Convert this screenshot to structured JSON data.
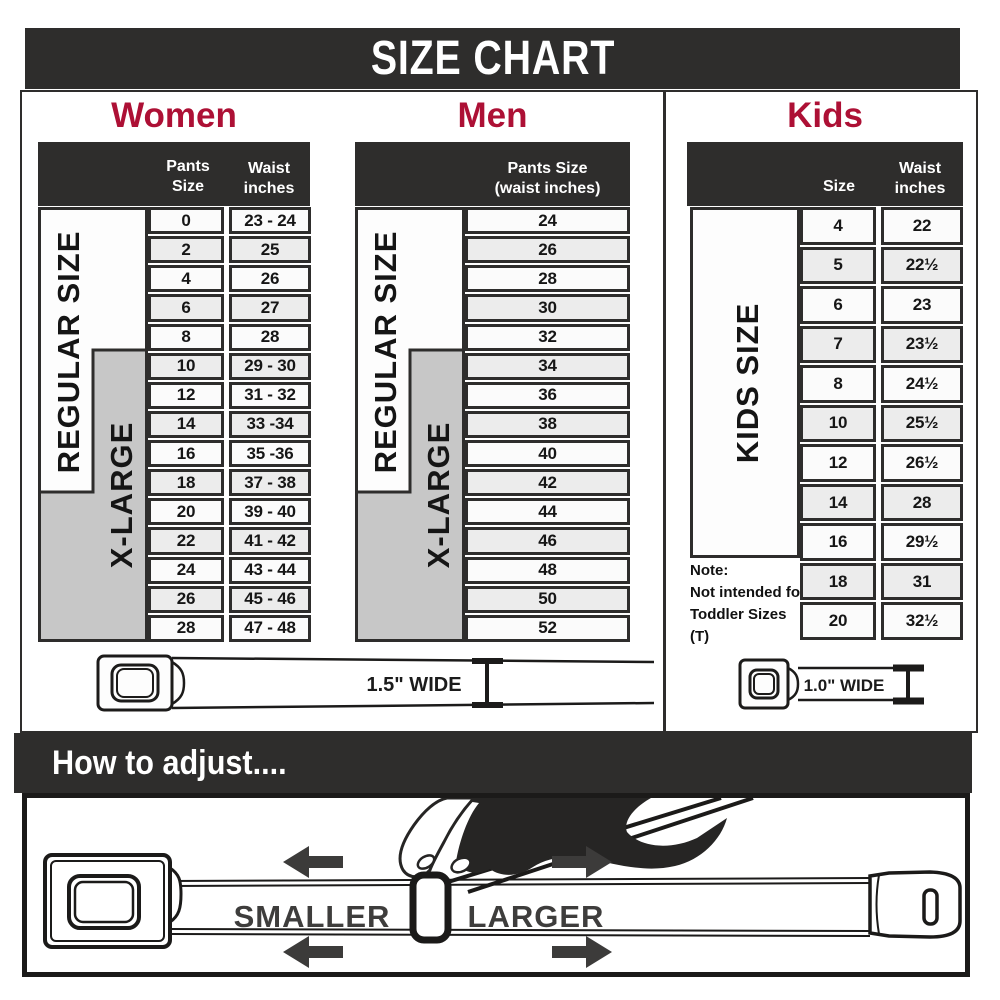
{
  "banner": {
    "title": "SIZE CHART"
  },
  "women": {
    "heading": "Women",
    "header": {
      "col1": "Pants Size",
      "col2_line1": "Waist",
      "col2_line2": "inches"
    },
    "labels": {
      "regular": "REGULAR SIZE",
      "xlarge": "X-LARGE"
    },
    "rows": [
      {
        "size": "0",
        "waist": "23 - 24"
      },
      {
        "size": "2",
        "waist": "25"
      },
      {
        "size": "4",
        "waist": "26"
      },
      {
        "size": "6",
        "waist": "27"
      },
      {
        "size": "8",
        "waist": "28"
      },
      {
        "size": "10",
        "waist": "29 - 30"
      },
      {
        "size": "12",
        "waist": "31 - 32"
      },
      {
        "size": "14",
        "waist": "33 -34"
      },
      {
        "size": "16",
        "waist": "35 -36"
      },
      {
        "size": "18",
        "waist": "37 - 38"
      },
      {
        "size": "20",
        "waist": "39 - 40"
      },
      {
        "size": "22",
        "waist": "41 - 42"
      },
      {
        "size": "24",
        "waist": "43 - 44"
      },
      {
        "size": "26",
        "waist": "45 - 46"
      },
      {
        "size": "28",
        "waist": "47 - 48"
      }
    ]
  },
  "men": {
    "heading": "Men",
    "header": {
      "line1": "Pants Size",
      "line2": "(waist inches)"
    },
    "labels": {
      "regular": "REGULAR SIZE",
      "xlarge": "X-LARGE"
    },
    "rows": [
      "24",
      "26",
      "28",
      "30",
      "32",
      "34",
      "36",
      "38",
      "40",
      "42",
      "44",
      "46",
      "48",
      "50",
      "52"
    ]
  },
  "kids": {
    "heading": "Kids",
    "header": {
      "col1": "Size",
      "col2_line1": "Waist",
      "col2_line2": "inches"
    },
    "labels": {
      "side": "KIDS SIZE"
    },
    "note": {
      "line1": "Note:",
      "line2": "Not intended for",
      "line3": "Toddler Sizes (T)"
    },
    "rows": [
      {
        "size": "4",
        "waist": "22"
      },
      {
        "size": "5",
        "waist": "22½"
      },
      {
        "size": "6",
        "waist": "23"
      },
      {
        "size": "7",
        "waist": "23½"
      },
      {
        "size": "8",
        "waist": "24½"
      },
      {
        "size": "10",
        "waist": "25½"
      },
      {
        "size": "12",
        "waist": "26½"
      },
      {
        "size": "14",
        "waist": "28"
      },
      {
        "size": "16",
        "waist": "29½"
      },
      {
        "size": "18",
        "waist": "31"
      },
      {
        "size": "20",
        "waist": "32½"
      }
    ]
  },
  "belts": {
    "adult_label": "1.5\" WIDE",
    "kids_label": "1.0\" WIDE"
  },
  "adjust": {
    "heading": "How to adjust....",
    "smaller": "SMALLER",
    "larger": "LARGER"
  },
  "colors": {
    "dark": "#2e2d2c",
    "red": "#ad1035",
    "label_gray": "#c7c7c7",
    "row_light": "#fbfbfb",
    "row_alt": "#ececec"
  }
}
